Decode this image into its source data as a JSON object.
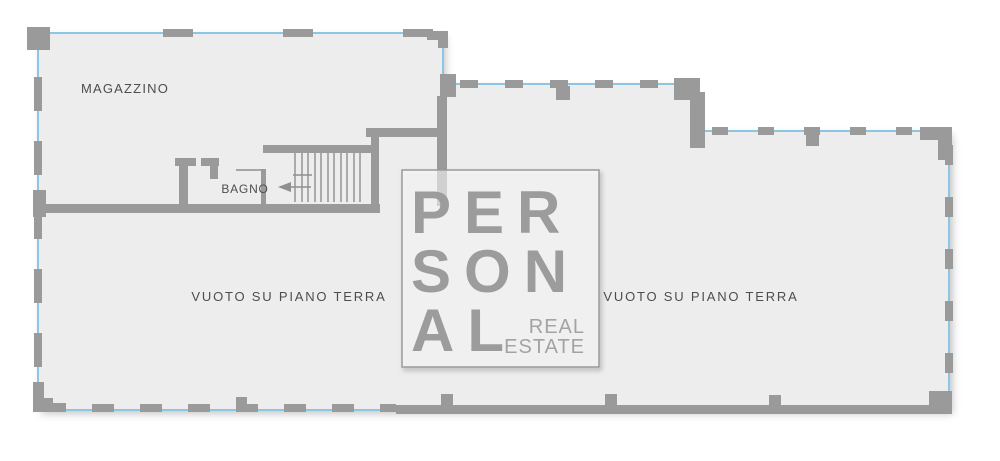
{
  "plan": {
    "rooms": {
      "magazzino": "MAGAZZINO",
      "bagno": "BAGNO",
      "void_left": "VUOTO SU PIANO TERRA",
      "void_right": "VUOTO SU PIANO TERRA"
    },
    "stairs": {
      "arrow_direction": "left"
    }
  },
  "watermark": {
    "line1": "PER",
    "line2": "SON",
    "line3": "AL",
    "tagline_line1": "REAL",
    "tagline_line2": "ESTATE"
  },
  "colors": {
    "floor": "#ededed",
    "wall": "#9a9a9a",
    "perimeter_accent": "#8dc6e4",
    "label_text": "#4d4d4d",
    "watermark_text": "#9c9c9c"
  }
}
